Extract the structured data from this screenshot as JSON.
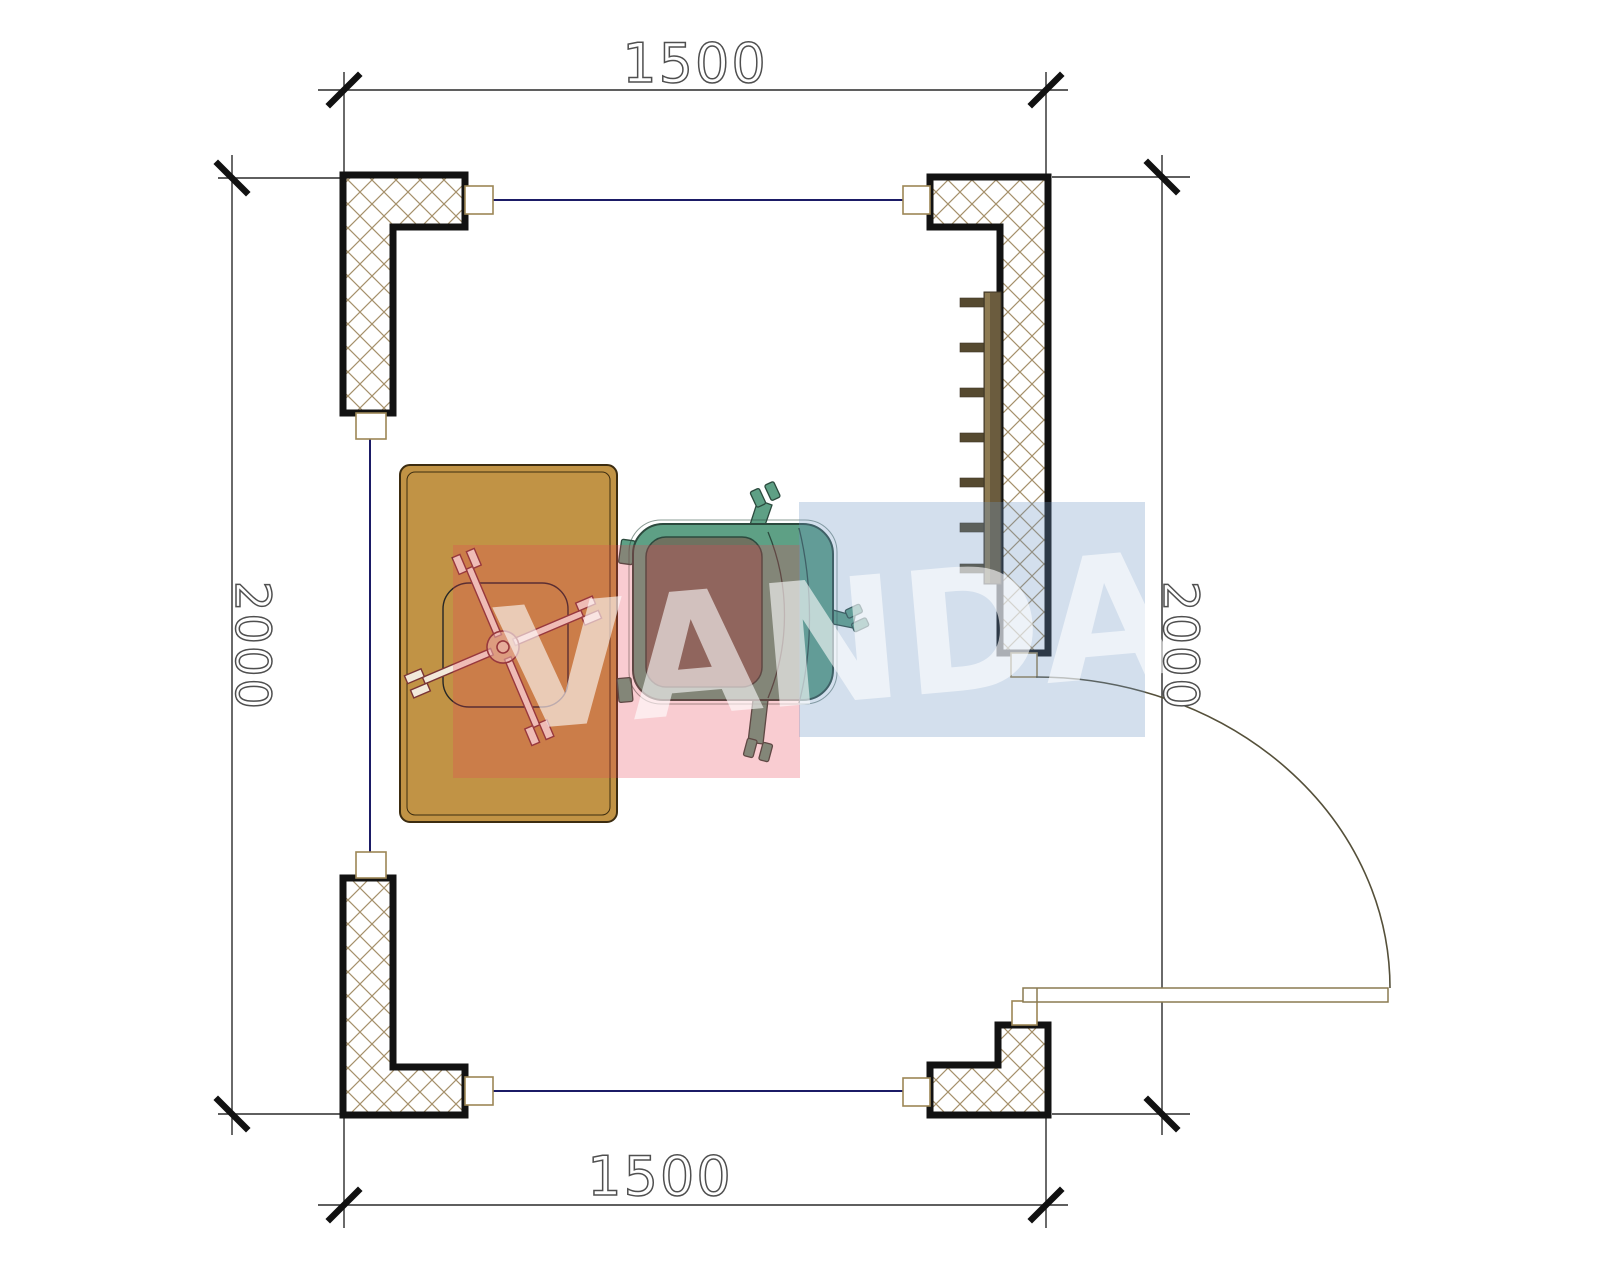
{
  "plan": {
    "title": "room-floor-plan",
    "dimensions": {
      "top": {
        "label": "1500"
      },
      "bottom": {
        "label": "1500"
      },
      "left": {
        "label": "2000"
      },
      "right": {
        "label": "2000"
      }
    },
    "watermark": {
      "text": "VANDA",
      "letters": [
        "V",
        "A",
        "N",
        "D",
        "A"
      ]
    },
    "colors": {
      "wall_outline": "#121212",
      "hatch": "#a5906a",
      "connector": "#9c8655",
      "window_line": "#1b1b66",
      "dim_line": "#2a2a2a",
      "dim_text_outline": "#4f4f4f",
      "desk_fill": "#c19345",
      "desk_outline": "#3c2c10",
      "chair_base": "#7a3535",
      "chair_fill": "#f2e9da",
      "armchair_frame": "#5ea085",
      "armchair_cushion": "#6f7260",
      "armchair_outline": "#2c4a3e",
      "radiator_bar": "#6b5c3e",
      "radiator_highlight": "#8d7a52",
      "radiator_tab": "#55492f",
      "door_line": "#8a7a50",
      "arc_line": "#55503a",
      "wm_red": "rgba(233,68,85,0.27)",
      "wm_blue": "rgba(110,148,196,0.30)",
      "wm_text": "rgba(255,255,255,0.60)"
    }
  }
}
